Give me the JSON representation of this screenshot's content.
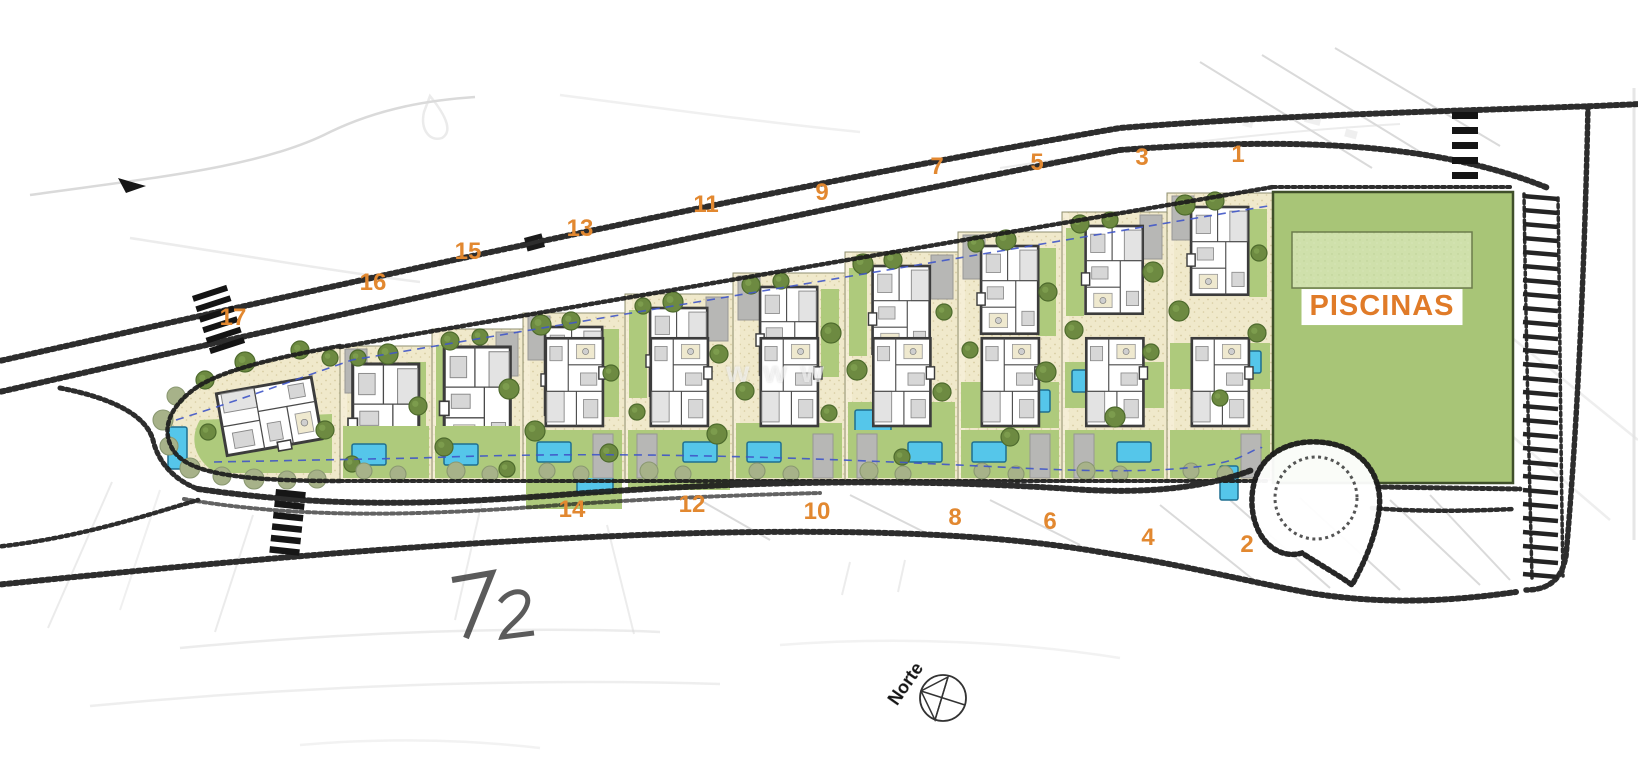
{
  "site_plan": {
    "plot_labels": [
      {
        "number": "17"
      },
      {
        "number": "16"
      },
      {
        "number": "15"
      },
      {
        "number": "13"
      },
      {
        "number": "11"
      },
      {
        "number": "9"
      },
      {
        "number": "7"
      },
      {
        "number": "5"
      },
      {
        "number": "3"
      },
      {
        "number": "1"
      },
      {
        "number": "14"
      },
      {
        "number": "12"
      },
      {
        "number": "10"
      },
      {
        "number": "8"
      },
      {
        "number": "6"
      },
      {
        "number": "4"
      },
      {
        "number": "2"
      }
    ],
    "amenity_label": "PISCINAS",
    "north_label": "Norte",
    "watermark": "www",
    "colors": {
      "plot_number_orange": "#e28830",
      "amenity_label_orange": "#e07b28",
      "sand": "#f0e9cb",
      "sand_dot": "#d8cda2",
      "grass": "#aeca7c",
      "amenity_green": "#a8c577",
      "amenity_pool_green": "#cfe0ab",
      "pool_blue": "#55c6ea",
      "pool_border": "#1f6f90",
      "tree_dark": "#6d8a41",
      "tree_dark_edge": "#4e6b2d",
      "tree_light": "#a7b289",
      "tree_light_edge": "#8a9871",
      "driveway_gray": "#b7b7b5",
      "road_ink": "#1c1c1c",
      "utility_blue": "#4056c8"
    }
  }
}
